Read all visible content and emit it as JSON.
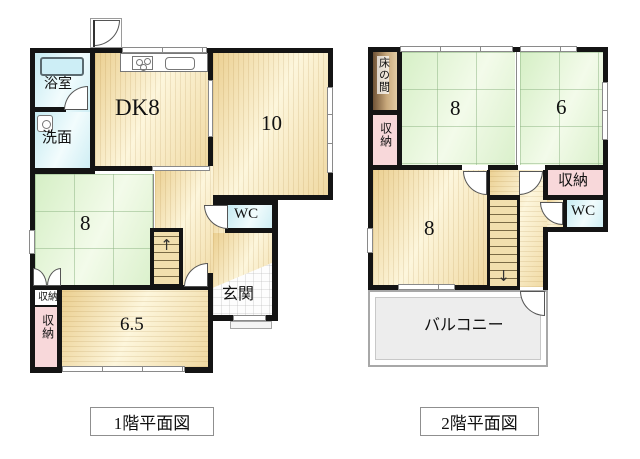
{
  "floor1": {
    "title": "1階平面図",
    "bath": "浴室",
    "washroom": "洗面",
    "dining_kitchen": "DK8",
    "room10": "10",
    "tatami8": "8",
    "wc": "WC",
    "genkan": "玄関",
    "closet_small": "収納",
    "closet": "収納",
    "room65": "6.5",
    "stairs_arrow": "↑"
  },
  "floor2": {
    "title": "2階平面図",
    "tokonoma": "床の間",
    "closet_left": "収納",
    "tatami8": "8",
    "tatami6": "6",
    "closet_right": "収納",
    "wc": "WC",
    "room8": "8",
    "balcony": "バルコニー",
    "stairs_arrow": "↓"
  },
  "colors": {
    "wall": "#141414",
    "wood": "#f0d9a2",
    "tatami": "#d9f0cb",
    "water": "#d4eef4",
    "closet_pink": "#f8d8da",
    "tokonoma_brown": "#8a6a46",
    "balcony_gray": "#ededed"
  }
}
